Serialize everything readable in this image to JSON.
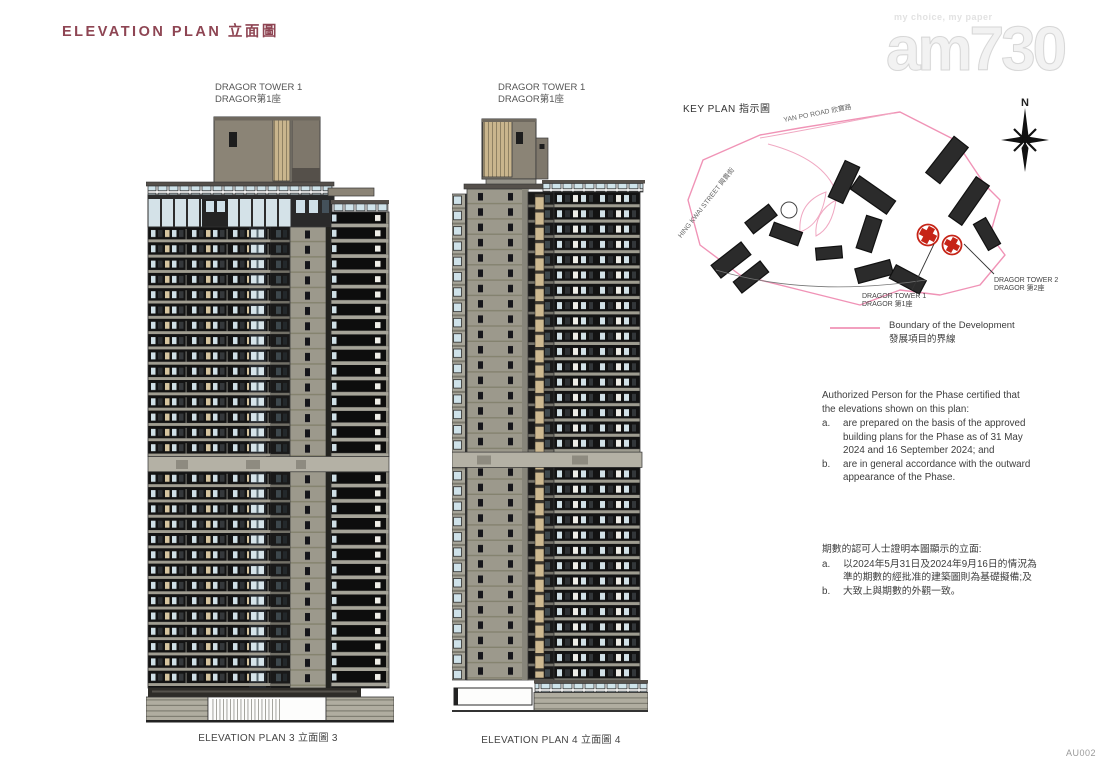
{
  "page": {
    "title": "ELEVATION PLAN 立面圖",
    "sheet_code": "AU002"
  },
  "watermark": {
    "tagline": "my choice, my paper",
    "logo": "am730"
  },
  "elevations": [
    {
      "tower_en": "DRAGOR TOWER 1",
      "tower_zh": "DRAGOR第1座",
      "caption": "ELEVATION PLAN 3 立面圖 3"
    },
    {
      "tower_en": "DRAGOR TOWER 1",
      "tower_zh": "DRAGOR第1座",
      "caption": "ELEVATION PLAN 4 立面圖 4"
    }
  ],
  "key_plan": {
    "title": "KEY PLAN 指示圖",
    "north": "N",
    "roads": [
      {
        "label": "YAN PO ROAD 欣寶路"
      },
      {
        "label": "HING KWAI STREET 興貴街"
      }
    ],
    "map_labels": [
      {
        "en": "DRAGOR TOWER 1",
        "zh": "DRAGOR 第1座"
      },
      {
        "en": "DRAGOR TOWER 2",
        "zh": "DRAGOR 第2座"
      }
    ],
    "legend": {
      "en": "Boundary of the Development",
      "zh": "發展項目的界線"
    }
  },
  "notes_en": {
    "intro": "Authorized Person for the Phase certified that the elevations shown on this plan:",
    "items": [
      {
        "key": "a.",
        "text": "are prepared on the basis of the approved building plans for the Phase as of 31 May 2024 and 16 September 2024; and"
      },
      {
        "key": "b.",
        "text": "are in general accordance with the outward appearance of the Phase."
      }
    ]
  },
  "notes_zh": {
    "intro": "期數的認可人士證明本圖顯示的立面:",
    "items": [
      {
        "key": "a.",
        "text": "以2024年5月31日及2024年9月16日的情況為準的期數的經批准的建築圖則為基礎擬備;及"
      },
      {
        "key": "b.",
        "text": "大致上與期數的外觀一致。"
      }
    ]
  },
  "colors": {
    "title_maroon": "#8e4553",
    "boundary_pink": "#f093b6",
    "highlight_red": "#c62417",
    "facade_dark": "#131313",
    "concrete_gray": "#9c998c",
    "wood_tan": "#c9b58d"
  }
}
